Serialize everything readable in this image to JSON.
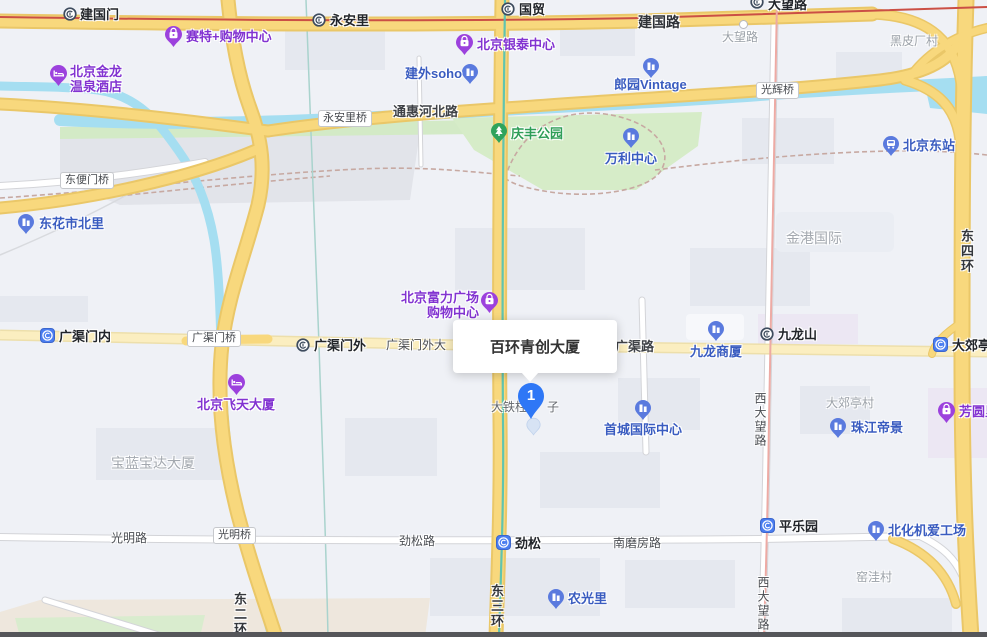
{
  "map": {
    "tooltip_title": "百环青创大厦",
    "marker_label": "1"
  },
  "stations": {
    "jianguomen": "建国门",
    "yonganli": "永安里",
    "guomao": "国贸",
    "dawanglu": "大望路",
    "guangqumenwai": "广渠门外",
    "jiulongshan": "九龙山",
    "guangqumennei": "广渠门内",
    "jinsong": "劲松",
    "pingleyuan": "平乐园",
    "dajiaoting": "大郊亭"
  },
  "pois": {
    "saite": "赛特+购物中心",
    "yintai": "北京银泰中心",
    "fuli_line1": "北京富力广场",
    "fuli_line2": "购物中心",
    "fangyuanli": "芳圆里",
    "jinlong_line1": "北京金龙",
    "jinlong_line2": "温泉酒店",
    "feitian": "北京飞天大厦",
    "jianwaisoho": "建外soho",
    "langyuan": "郎园Vintage",
    "wanli": "万利中心",
    "beijingdong": "北京东站",
    "donghuashi": "东花市北里",
    "jiulongshangsha": "九龙商厦",
    "shoucheng": "首城国际中心",
    "zhujiang": "珠江帝景",
    "nongguangli": "农光里",
    "beihuaji": "北化机爱工场",
    "qingfeng": "庆丰公园"
  },
  "roads": {
    "jianguolu": "建国路",
    "tonghui": "通惠河北路",
    "guangqumenwai_st": "广渠门外大",
    "guangqulu": "广渠路",
    "guangming": "光明路",
    "jinsonglu": "劲松路",
    "nanmofang": "南磨房路",
    "dongsihuan": "东四环",
    "dongsanhuan": "东三环",
    "dongerhuan": "东二环",
    "xidawang_1": "西大望路",
    "xidawang_2": "西大望路"
  },
  "bridges": {
    "yonganliqiao": "永安里桥",
    "dongbianmen": "东便门桥",
    "guangqumenqiao": "广渠门桥",
    "guanghuiqiao": "光辉桥",
    "guangmingqiao": "光明桥"
  },
  "areas": {
    "heipichang": "黑皮厂村",
    "dawanglu_road": "大望路",
    "jingang": "金港国际",
    "dajiaotingcun": "大郊亭村",
    "baolan": "宝蓝宝达大厦",
    "yaowacun": "窑洼村",
    "datiezhu": "大铁柱",
    "datiezhu_tail": "子"
  },
  "colors": {
    "highway_yellow": "#f8d87d",
    "minor_yellow": "#fbeec0",
    "water": "#a5def1",
    "park": "#d6ecc8",
    "metro_red": "#cb4f45",
    "metro_teal": "#4fc2b6",
    "metro_pink": "#edaaa4",
    "marker_blue": "#2e77f6"
  }
}
